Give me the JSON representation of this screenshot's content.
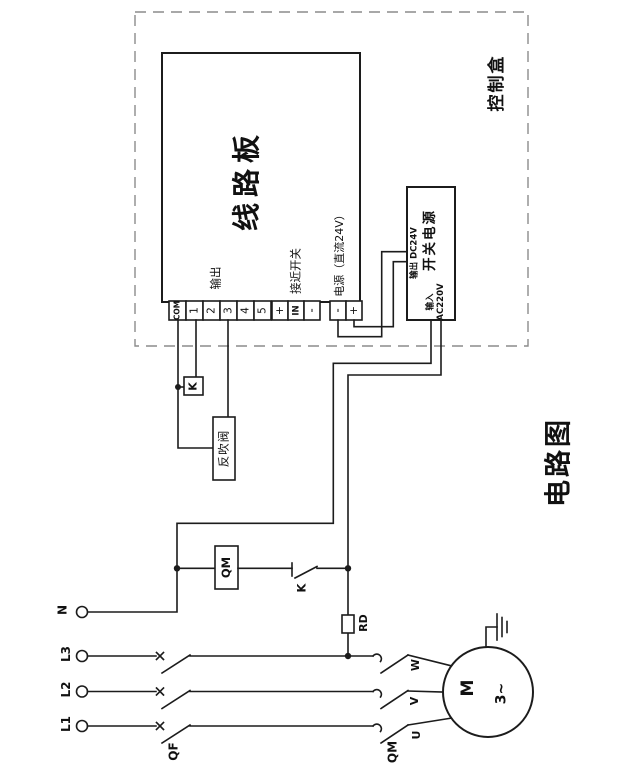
{
  "title": "电路图",
  "control_box": {
    "label": "控制盒"
  },
  "board": {
    "label": "线路板",
    "groups": [
      {
        "label": "输出",
        "terminals": [
          "COM",
          "1",
          "2",
          "3",
          "4",
          "5"
        ]
      },
      {
        "label": "接近开关",
        "terminals": [
          "+",
          "IN",
          "-"
        ]
      },
      {
        "label": "电源（直流24V）",
        "terminals": [
          "-",
          "+"
        ]
      }
    ]
  },
  "psu": {
    "label": "开关电源",
    "output_label": "输出 DC24V",
    "input_label": "输入",
    "input_voltage": "AC220V"
  },
  "components": {
    "relay": "K",
    "valve": "反吹阀",
    "coil": "QM",
    "contact": "K",
    "fuse": "RD",
    "breaker": "QF",
    "contactor": "QM",
    "motor": "M",
    "phase": "3~"
  },
  "supply": {
    "terminals": [
      "N",
      "L3",
      "L2",
      "L1"
    ]
  },
  "motor_leads": [
    "W",
    "V",
    "U"
  ],
  "colors": {
    "line": "#1c1c1c",
    "dashed": "#8c8c8c",
    "bg": "#ffffff"
  }
}
